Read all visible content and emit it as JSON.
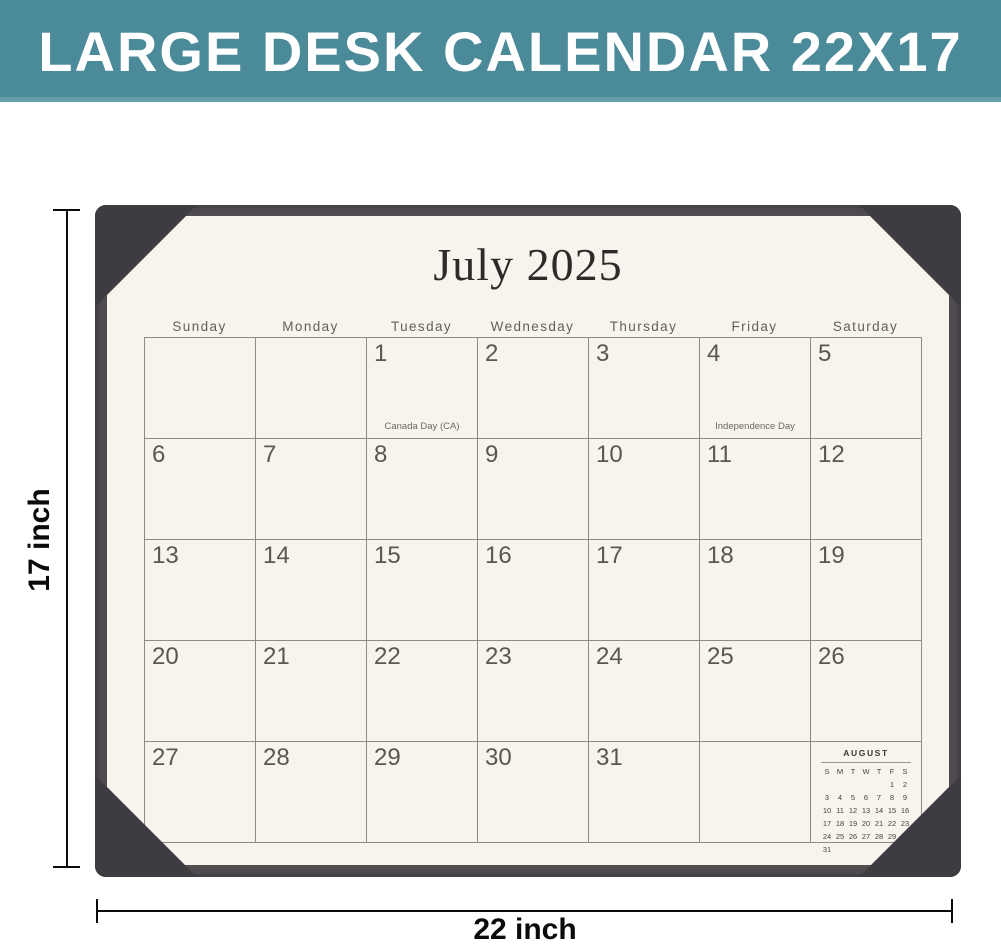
{
  "banner": {
    "label": "LARGE DESK CALENDAR 22X17"
  },
  "dimension_annotations": {
    "height": "17 inch",
    "width": "22 inch"
  },
  "calendar": {
    "month_title": "July 2025",
    "weekday_headers": [
      "Sunday",
      "Monday",
      "Tuesday",
      "Wednesday",
      "Thursday",
      "Friday",
      "Saturday"
    ],
    "weeks": [
      [
        {
          "date": ""
        },
        {
          "date": ""
        },
        {
          "date": "1",
          "note": "Canada Day (CA)"
        },
        {
          "date": "2"
        },
        {
          "date": "3"
        },
        {
          "date": "4",
          "note": "Independence Day"
        },
        {
          "date": "5"
        }
      ],
      [
        {
          "date": "6"
        },
        {
          "date": "7"
        },
        {
          "date": "8"
        },
        {
          "date": "9"
        },
        {
          "date": "10"
        },
        {
          "date": "11"
        },
        {
          "date": "12"
        }
      ],
      [
        {
          "date": "13"
        },
        {
          "date": "14"
        },
        {
          "date": "15"
        },
        {
          "date": "16"
        },
        {
          "date": "17"
        },
        {
          "date": "18"
        },
        {
          "date": "19"
        }
      ],
      [
        {
          "date": "20"
        },
        {
          "date": "21"
        },
        {
          "date": "22"
        },
        {
          "date": "23"
        },
        {
          "date": "24"
        },
        {
          "date": "25"
        },
        {
          "date": "26"
        }
      ],
      [
        {
          "date": "27"
        },
        {
          "date": "28"
        },
        {
          "date": "29"
        },
        {
          "date": "30"
        },
        {
          "date": "31"
        },
        {
          "date": ""
        },
        {
          "date": "",
          "mini_month": true
        }
      ]
    ],
    "mini_month": {
      "title": "AUGUST",
      "weekday_initials": [
        "S",
        "M",
        "T",
        "W",
        "T",
        "F",
        "S"
      ],
      "weeks": [
        [
          "",
          "",
          "",
          "",
          "",
          "1",
          "2"
        ],
        [
          "3",
          "4",
          "5",
          "6",
          "7",
          "8",
          "9"
        ],
        [
          "10",
          "11",
          "12",
          "13",
          "14",
          "15",
          "16"
        ],
        [
          "17",
          "18",
          "19",
          "20",
          "21",
          "22",
          "23"
        ],
        [
          "24",
          "25",
          "26",
          "27",
          "28",
          "29",
          "30"
        ],
        [
          "31",
          "",
          "",
          "",
          "",
          "",
          ""
        ]
      ]
    }
  },
  "colors": {
    "banner_bg": "#4b8a99",
    "banner_text": "#ffffff",
    "mat": "#524f53",
    "corner_pocket": "#3e3c41",
    "paper": "#f7f4ed",
    "grid_line": "#8e8b84",
    "date_text": "#5a5751",
    "annotation": "#0b0b0b"
  }
}
